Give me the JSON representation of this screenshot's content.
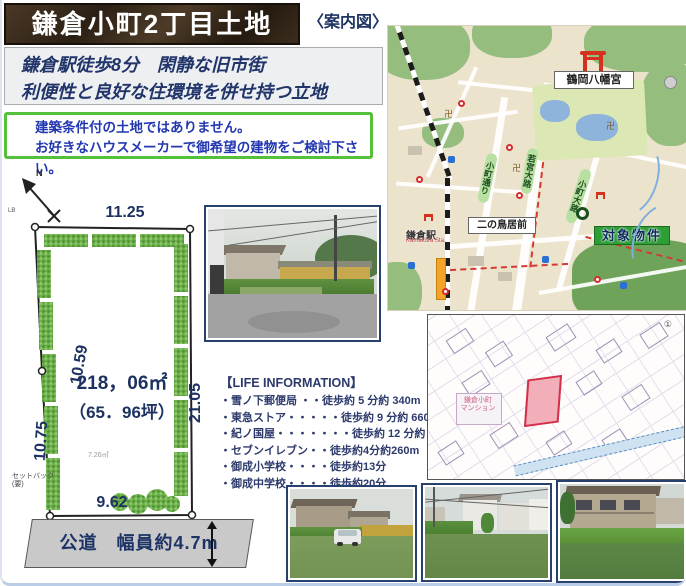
{
  "header": {
    "title": "鎌倉小町2丁目土地",
    "map_caption": "〈案内図〉",
    "catch_line1": "鎌倉駅徒歩8分　閑静な旧市街",
    "catch_line2": "利便性と良好な住環境を併せ持つ立地"
  },
  "notice": {
    "line1": "建築条件付の土地ではありません。",
    "line2": "お好きなハウスメーカーで御希望の建物をご検討下さい。"
  },
  "plot": {
    "north_label": "N",
    "corner_label": "LB",
    "dim_top": "11.25",
    "dim_left_upper": "10.59",
    "dim_left_lower": "10.75",
    "dim_right": "21.05",
    "dim_bottom": "9.62",
    "area_sqm": "218，06㎡",
    "area_tsubo": "（65．96坪）",
    "inner_note": "7.26㎡",
    "setback_note": "セットバック(要)"
  },
  "road": {
    "label": "公道　幅員約4.7m"
  },
  "life_information": {
    "heading": "【LIFE INFORMATION】",
    "items": [
      "・雪ノ下郵便局 ・・徒歩約 5 分約 340m",
      "・東急ストア・・・・・徒歩約 9 分約 660m",
      "・紀ノ国屋・・・・・・・徒歩約 12 分約 900m",
      "・セブンイレブン・・徒歩約4分約260m",
      "・御成小学校・・・・徒歩約13分",
      "・御成中学校・・・・徒歩約20分"
    ]
  },
  "guide_map": {
    "shrine_label": "鶴岡八幡宮",
    "station_label": "鎌倉駅",
    "station_sublabel": "Kamakura Sta.",
    "nino_torii_label": "二の鳥居前",
    "property_label": "対象物件",
    "road_labels": [
      "小町通り",
      "若宮大路",
      "小町大路"
    ],
    "temple_mark": "卍"
  },
  "cadastral_map": {
    "label_line1": "鎌倉小町",
    "label_line2": "マンション",
    "circled_number": "①"
  },
  "colors": {
    "title_bg": "#3a2b1c",
    "accent_green": "#55c13a",
    "text_navy": "#1e3366",
    "notice_blue": "#2337b0",
    "map_green": "#2e9e36",
    "parcel_pink": "#f2afba",
    "parcel_red": "#d2304a"
  }
}
